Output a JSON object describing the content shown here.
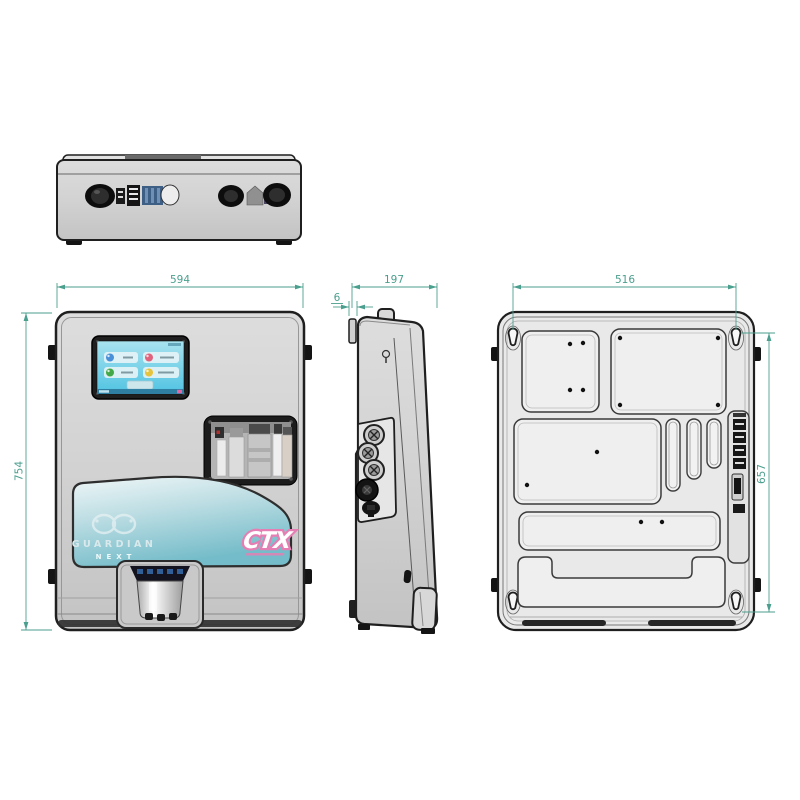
{
  "drawing_type": "technical-orthographic-views",
  "dimensions": {
    "front_width": "594",
    "side_depth": "197",
    "mount_offset": "6",
    "mount_width": "516",
    "front_height": "754",
    "mount_height": "657"
  },
  "branding": {
    "product_line1": "GUARDIAN",
    "product_line2": "NEXT",
    "logo": "CTX"
  },
  "colors": {
    "dimension_teal": "#4b9f8e",
    "body_grey": "#d2d2d2",
    "outline": "#1f1f1f",
    "screen_cyan": "#5fc9e2",
    "panel_teal": "#7fc0cb",
    "logo_pink": "#e57fb3",
    "icon_blue": "#4a90d9",
    "icon_red": "#e0637e",
    "icon_green": "#43a847",
    "icon_yellow": "#e6c33c"
  }
}
